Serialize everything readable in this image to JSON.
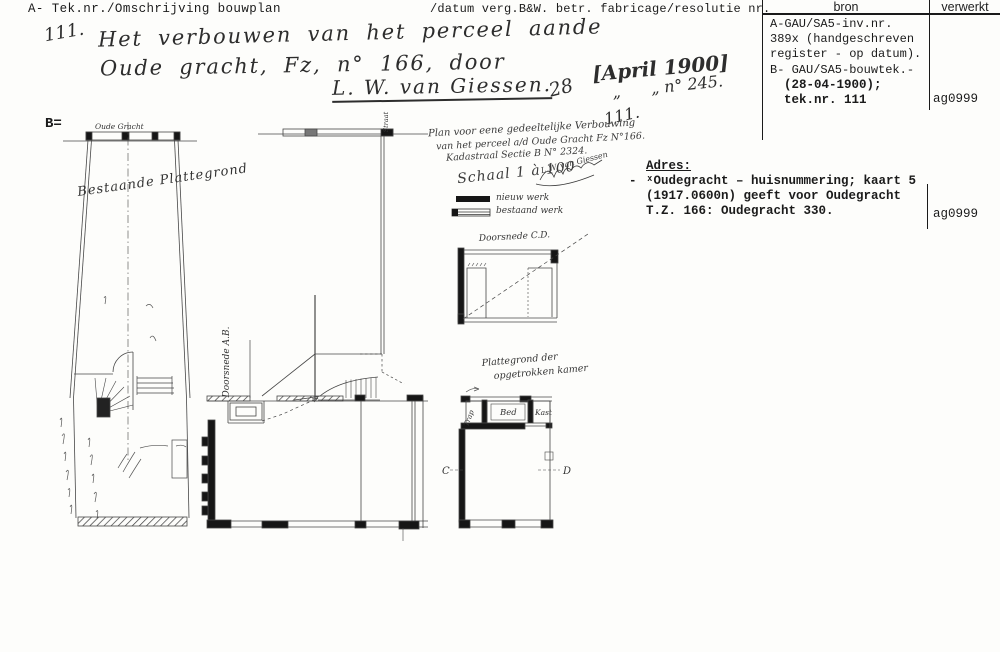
{
  "page": {
    "header_left": "A- Tek.nr./Omschrijving bouwplan",
    "header_mid": "/datum verg.B&W. betr. fabricage/resolutie nr.",
    "section_marker": "B="
  },
  "table": {
    "col_bron": "bron",
    "col_verwerkt": "verwerkt",
    "bron_lines": [
      "A-GAU/SA5-inv.nr.",
      "389x (handgeschreven",
      "register - op datum).",
      "B- GAU/SA5-bouwtek.-"
    ],
    "bron_bold_lines": [
      "(28-04-1900);",
      "tek.nr. 111"
    ],
    "verwerkt_value": "ag0999",
    "adres": {
      "heading": "Adres:",
      "bullet": "-",
      "lines": [
        "ˣOudegracht – huisnummering; kaart 5",
        "(1917.0600n) geeft voor Oudegracht",
        "T.Z. 166: Oudegracht 330."
      ],
      "verwerkt_value": "ag0999"
    }
  },
  "handwriting": {
    "number": "111.",
    "line1": "Het verbouwen van het perceel aande",
    "line2": "Oude gracht, Fz, n° 166, door",
    "signature": "L. W. van Giessen.",
    "day": "28",
    "date_bracket": "[April 1900]",
    "ditto_resolutie": "„      „ n° 245.",
    "number_repeat": "111."
  },
  "drawings": {
    "left_plan": {
      "street_label": "Oude Gracht",
      "name_label": "Bestaande Plattegrond"
    },
    "section_ab": {
      "label": "Doorsnede A.B.",
      "street_label": "Straat"
    },
    "title_block": {
      "line1": "Plan voor eene gedeeltelijke Verbouwing",
      "line2": "van het perceel a/d Oude Gracht Fz N°166.",
      "line3": "Kadastraal Sectie B N° 2324.",
      "scale": "Schaal 1 à 100",
      "legend_new": "nieuw werk",
      "legend_old": "bestaand werk",
      "signature": "L.W. van Giessen"
    },
    "section_cd": {
      "label": "Doorsnede C.D."
    },
    "room_plan": {
      "label1": "Plattegrond der",
      "label2": "opgetrokken kamer",
      "room_trap": "Trap",
      "room_bed": "Bed",
      "room_kast": "Kast",
      "marker_c": "C",
      "marker_d": "D"
    }
  },
  "colors": {
    "ink": "#1a1a1a",
    "drawing_line": "#444444",
    "paper": "#fdfdfb"
  }
}
